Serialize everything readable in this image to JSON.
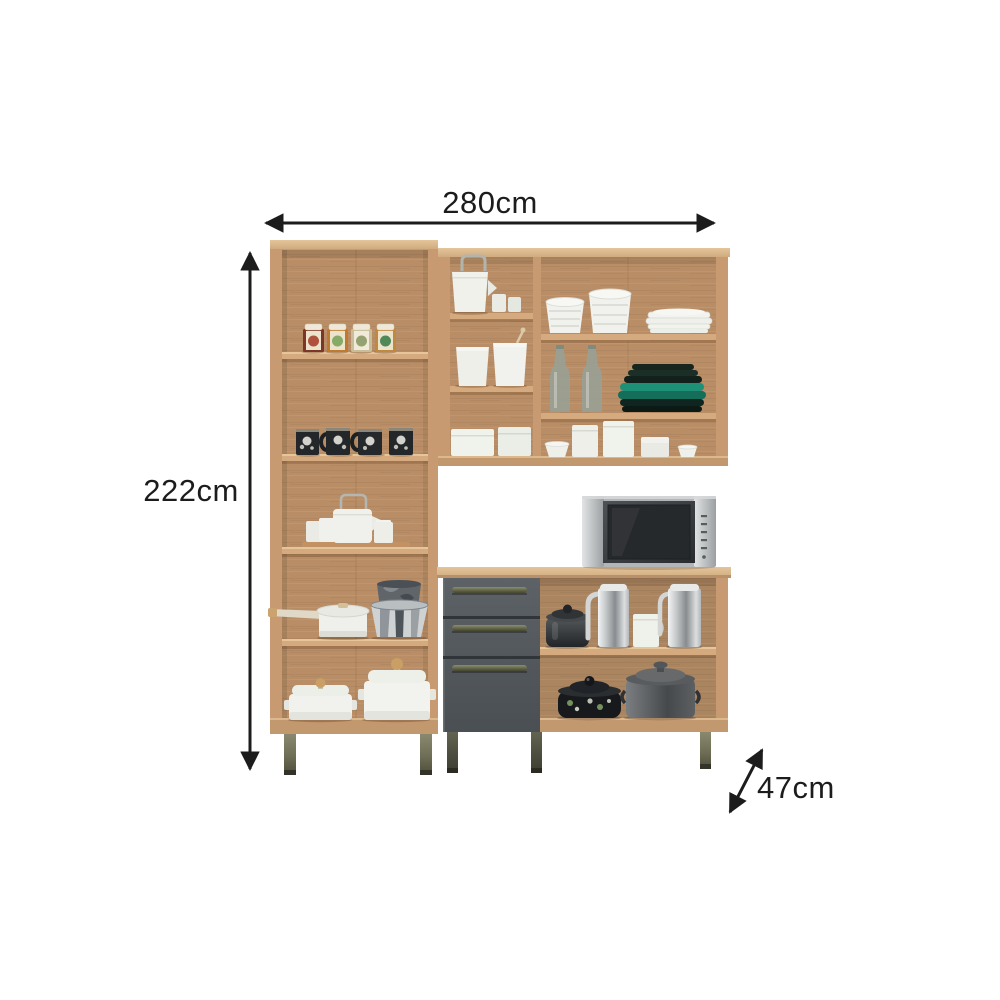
{
  "title": "Kitchen cabinet set dimension diagram",
  "background": "#ffffff",
  "annotation_color": "#1c1c1c",
  "dimensions": {
    "width_label": "280cm",
    "height_label": "222cm",
    "depth_label": "47cm"
  },
  "palette": {
    "wood_frame": "#c79a71",
    "wood_top": "#ddb98e",
    "wood_back": "#b98e66",
    "shelf_edge": "#d4aa7e",
    "drawer_front": "#53585c",
    "handle_metal": "#5d5f45",
    "leg_olive": "#6f6e57",
    "microwave_silver": "#c4c7c8",
    "microwave_door": "#35393c",
    "teal_plates": "#1e8f76",
    "white_ceramics": "#f1f2ee",
    "steel": "#c6c9ca"
  },
  "furniture": {
    "tall_cabinet": {
      "shelves": 5,
      "contents": [
        "spice tins",
        "black floral mugs",
        "white tea set",
        "saucepan and metal buckets",
        "white casserole pots"
      ]
    },
    "upper_cabinet": {
      "sections": 6,
      "contents": [
        "white kettle and jars",
        "canisters",
        "storage boxes",
        "bowl stacks",
        "white plate stack",
        "glass bottles",
        "teal plate stack",
        "small containers"
      ]
    },
    "base_cabinet": {
      "drawers": 3,
      "contents": [
        "microwave",
        "dark kettle",
        "steel jugs",
        "white canister",
        "floral pot",
        "gray stockpot"
      ]
    }
  }
}
